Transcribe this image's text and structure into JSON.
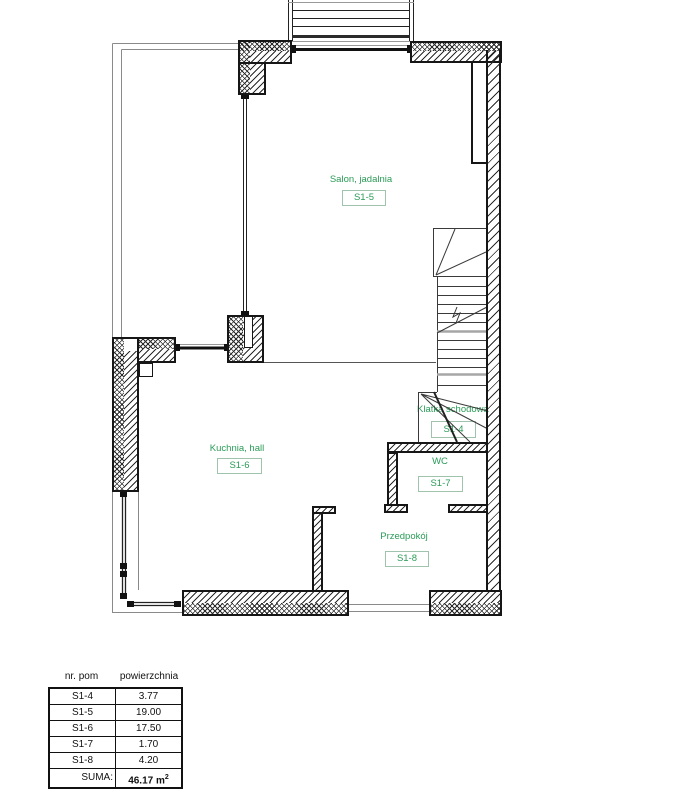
{
  "plan": {
    "label_color": "#2a9b57",
    "rooms": {
      "salon": {
        "name": "Salon, jadalnia",
        "code": "S1-5"
      },
      "kuchnia": {
        "name": "Kuchnia,  hall",
        "code": "S1-6"
      },
      "klatka": {
        "name": "Klatka schodowa",
        "code": "S1-4"
      },
      "wc": {
        "name": "WC",
        "code": "S1-7"
      },
      "przedpokoj": {
        "name": "Przedpokój",
        "code": "S1-8"
      }
    }
  },
  "table": {
    "header_col1": "nr. pom",
    "header_col2": "powierzchnia",
    "rows": [
      {
        "room": "S1-4",
        "area": "3.77"
      },
      {
        "room": "S1-5",
        "area": "19.00"
      },
      {
        "room": "S1-6",
        "area": "17.50"
      },
      {
        "room": "S1-7",
        "area": "1.70"
      },
      {
        "room": "S1-8",
        "area": "4.20"
      }
    ],
    "total_label": "SUMA:",
    "total_value": "46.17 m",
    "total_exponent": "2"
  }
}
